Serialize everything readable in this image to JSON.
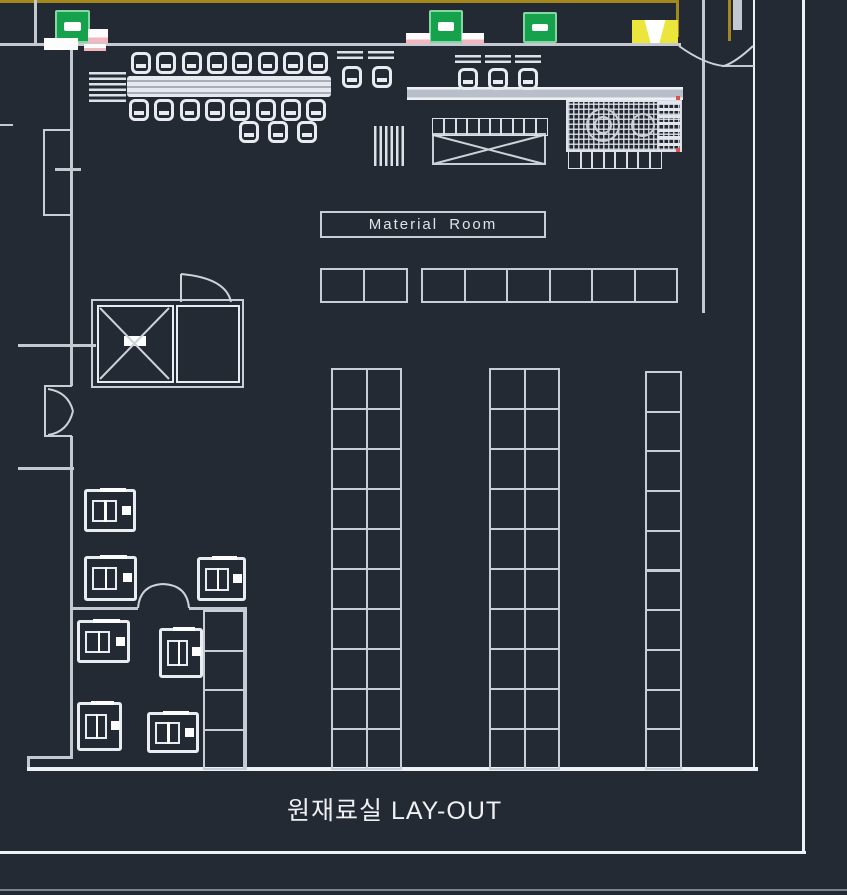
{
  "labels": {
    "title": "원재료실 LAY-OUT",
    "material_room": "Material Room"
  },
  "colors": {
    "background": "#242a33",
    "line": "#c9ced6",
    "line_bright": "#eef1f5",
    "boundary_yellow": "#a5881b",
    "door_sign_green": "#16a14c",
    "exit_sign_yellow": "#ece63c",
    "tick_pink": "#f0b9c0",
    "text": "#eef0f3"
  },
  "plan": {
    "door_signs": [
      {
        "x": 55,
        "y": 10,
        "w": 35,
        "h": 33
      },
      {
        "x": 429,
        "y": 10,
        "w": 34,
        "h": 33
      },
      {
        "x": 523,
        "y": 12,
        "w": 34,
        "h": 31
      }
    ],
    "exit_sign": {
      "x": 632,
      "y": 20,
      "w": 46,
      "h": 23
    },
    "pink_ticks": [
      {
        "x": 88,
        "y": 29,
        "w": 20,
        "h": 14
      },
      {
        "x": 406,
        "y": 33,
        "w": 24,
        "h": 11
      },
      {
        "x": 462,
        "y": 33,
        "w": 22,
        "h": 11
      },
      {
        "x": 84,
        "y": 44,
        "w": 22,
        "h": 7
      }
    ],
    "white_block": {
      "x": 44,
      "y": 38,
      "w": 34,
      "h": 12
    },
    "racks": [
      {
        "name": "shelf-row-left",
        "x": 320,
        "y": 268,
        "cols": 2,
        "rows": 1,
        "cellW": 43,
        "cellH": 33
      },
      {
        "name": "shelf-row-right",
        "x": 421,
        "y": 268,
        "cols": 6,
        "rows": 1,
        "cellW": 42.5,
        "cellH": 33
      },
      {
        "name": "rack-column-1",
        "x": 331,
        "y": 368,
        "cols": 2,
        "rows": 10,
        "cellW": 34.5,
        "cellH": 40
      },
      {
        "name": "rack-column-2",
        "x": 489,
        "y": 368,
        "cols": 2,
        "rows": 10,
        "cellW": 34.5,
        "cellH": 40
      },
      {
        "name": "rack-column-3",
        "x": 645,
        "y": 371,
        "cols": 1,
        "rows": 10,
        "cellW": 35,
        "cellH": 39.7
      },
      {
        "name": "storage-cells-column",
        "x": 203,
        "y": 610,
        "cols": 1,
        "rows": 4,
        "cellW": 42,
        "cellH": 39.5
      },
      {
        "name": "worktable-top-cells",
        "x": 432,
        "y": 118,
        "cols": 10,
        "rows": 1,
        "cellW": 11.4,
        "cellH": 16,
        "fine": true
      },
      {
        "name": "equipment-bottom-cells",
        "x": 568,
        "y": 151,
        "cols": 8,
        "rows": 1,
        "cellW": 11.5,
        "cellH": 16,
        "fine": true
      }
    ],
    "machines": [
      {
        "x": 84,
        "y": 489,
        "w": 52,
        "h": 43
      },
      {
        "x": 84,
        "y": 556,
        "w": 53,
        "h": 45
      },
      {
        "x": 197,
        "y": 557,
        "w": 49,
        "h": 44
      },
      {
        "x": 77,
        "y": 620,
        "w": 53,
        "h": 43
      },
      {
        "x": 159,
        "y": 628,
        "w": 44,
        "h": 50
      },
      {
        "x": 77,
        "y": 702,
        "w": 45,
        "h": 49
      },
      {
        "x": 147,
        "y": 712,
        "w": 52,
        "h": 41
      }
    ],
    "chair_rows": [
      {
        "x": 131,
        "y": 52,
        "count": 8,
        "step": 25.3
      },
      {
        "x": 129,
        "y": 99,
        "count": 8,
        "step": 25.3
      },
      {
        "x": 239,
        "y": 121,
        "count": 3,
        "step": 29
      },
      {
        "x": 342,
        "y": 66,
        "count": 2,
        "step": 30
      },
      {
        "x": 458,
        "y": 68,
        "count": 3,
        "step": 30
      }
    ],
    "hatch_blocks": [
      {
        "x": 89,
        "y": 72,
        "w": 37,
        "h": 33,
        "dir": "h"
      },
      {
        "x": 374,
        "y": 126,
        "w": 30,
        "h": 40,
        "dir": "v"
      },
      {
        "x": 337,
        "y": 51,
        "w": 26,
        "h": 11,
        "dir": "h"
      },
      {
        "x": 368,
        "y": 51,
        "w": 26,
        "h": 11,
        "dir": "h"
      },
      {
        "x": 455,
        "y": 55,
        "w": 26,
        "h": 11,
        "dir": "h"
      },
      {
        "x": 485,
        "y": 55,
        "w": 26,
        "h": 11,
        "dir": "h"
      },
      {
        "x": 515,
        "y": 55,
        "w": 26,
        "h": 11,
        "dir": "h"
      }
    ]
  }
}
